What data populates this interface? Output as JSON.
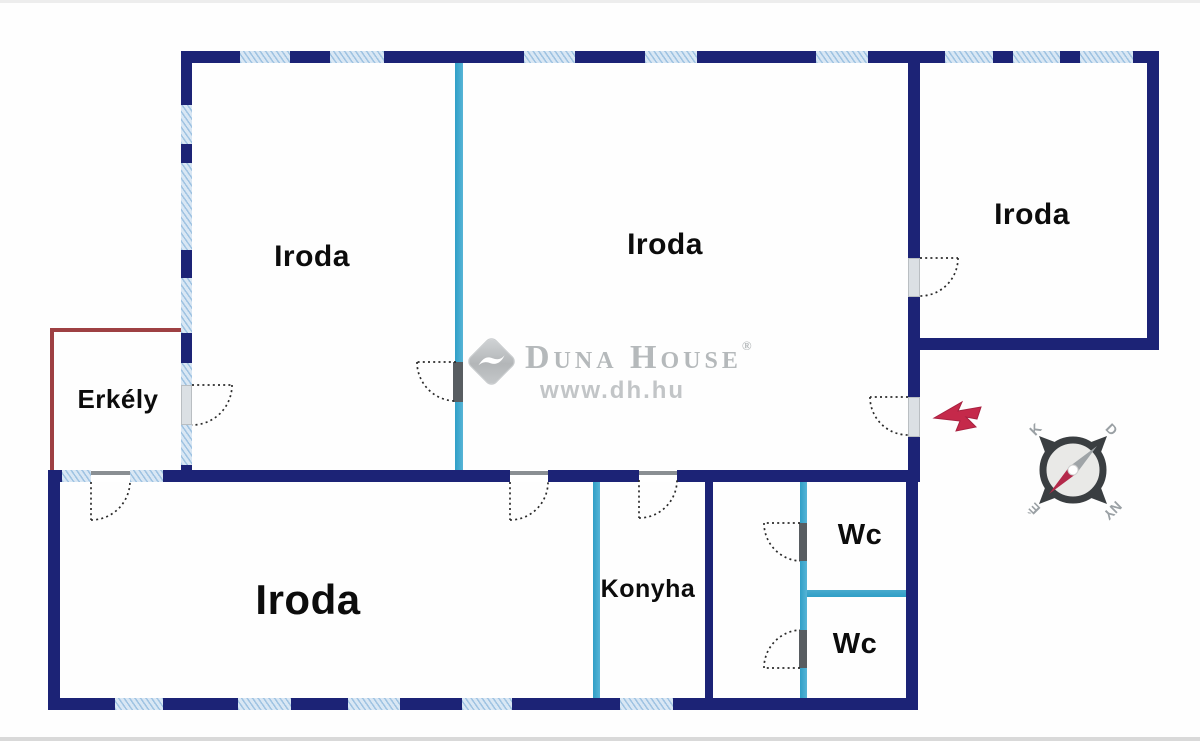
{
  "plan": {
    "type": "floor-plan",
    "rooms": [
      {
        "id": "iroda-top-left",
        "label": "Iroda"
      },
      {
        "id": "iroda-center",
        "label": "Iroda"
      },
      {
        "id": "iroda-top-right",
        "label": "Iroda"
      },
      {
        "id": "iroda-bottom",
        "label": "Iroda"
      },
      {
        "id": "erkely",
        "label": "Erkély"
      },
      {
        "id": "konyha",
        "label": "Konyha"
      },
      {
        "id": "wc-upper",
        "label": "Wc"
      },
      {
        "id": "wc-lower",
        "label": "Wc"
      }
    ]
  },
  "watermark": {
    "brand": "Duna House",
    "registered": "®",
    "url": "www.dh.hu"
  },
  "compass": {
    "east": "K",
    "south": "D",
    "north": "É",
    "west": "NY"
  },
  "colors": {
    "wall_navy": "#1c2376",
    "wall_teal": "#2f9fc7",
    "wall_teal_light": "#49aacd",
    "window_blue": "#d9e7f4",
    "balcony_red": "#9e4043",
    "entrance_arrow_red": "#c5294a",
    "watermark_gray": "#b5b9bb",
    "label_black": "#0c0c0c"
  }
}
